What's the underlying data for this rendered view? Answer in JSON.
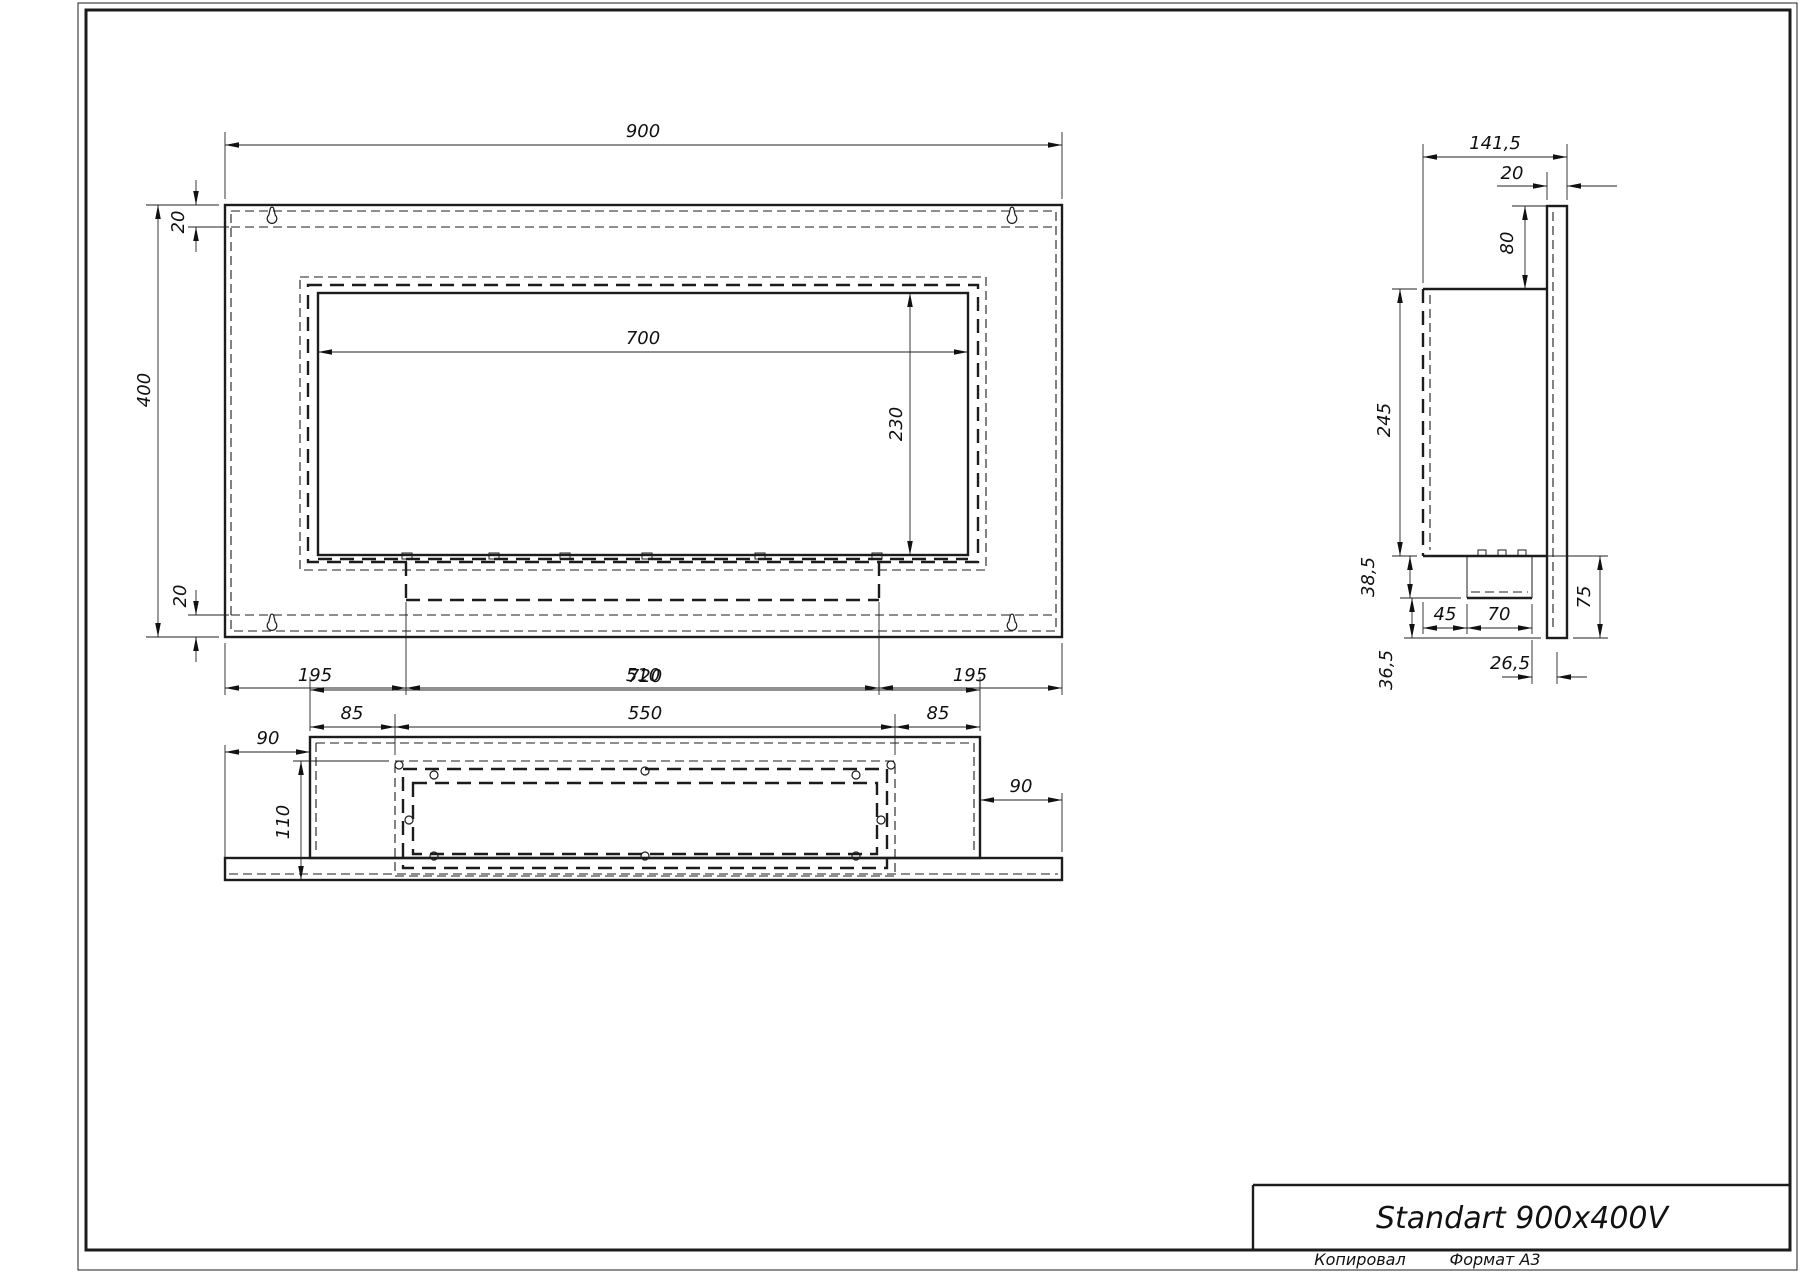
{
  "front": {
    "width": "900",
    "height": "400",
    "top_gap": "20",
    "bottom_gap": "20",
    "opening_width": "700",
    "opening_height": "230",
    "left": "195",
    "center": "510",
    "right": "195"
  },
  "side": {
    "depth": "141,5",
    "panel": "20",
    "top_offset": "80",
    "body_height": "245",
    "tray": "38,5",
    "gap45": "45",
    "burner": "70",
    "lower": "75",
    "offset265": "26,5",
    "offset365": "36,5"
  },
  "bottom": {
    "width": "720",
    "inset_left": "85",
    "frame": "550",
    "inset_right": "85",
    "offset_left": "90",
    "depth": "110",
    "offset_right": "90"
  },
  "titleblock": {
    "title": "Standart 900x400V",
    "copied": "Копировал",
    "format": "Формат А3"
  }
}
